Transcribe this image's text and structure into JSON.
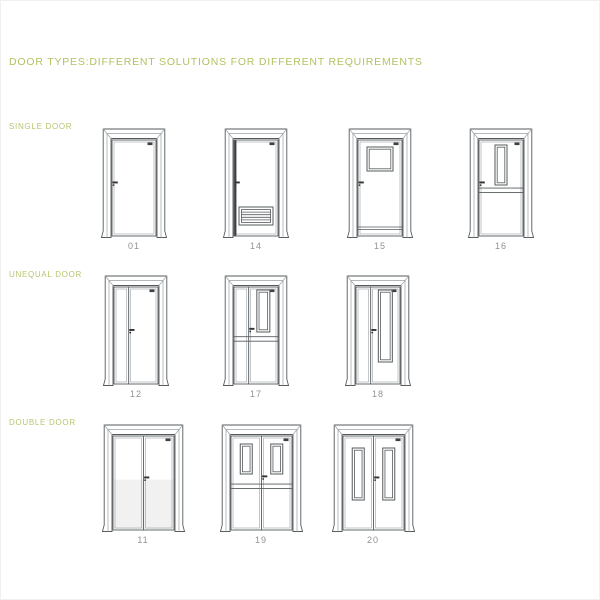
{
  "title": {
    "text": "DOOR TYPES:DIFFERENT SOLUTIONS FOR DIFFERENT REQUIREMENTS"
  },
  "colors": {
    "accent_green": "#b3c161",
    "line": "#565b5e",
    "line_light": "#9aa0a4",
    "dark_detail": "#3c4043",
    "number_gray": "#8f9193",
    "shade": "#f1f1f1",
    "background": "#ffffff"
  },
  "sections": [
    {
      "label": "SINGLE DOOR",
      "label_y": 121,
      "row_y": 126,
      "door_w": 66,
      "door_h": 111,
      "doors": [
        {
          "number": "01",
          "cx": 133,
          "kind": "single",
          "features": []
        },
        {
          "number": "14",
          "cx": 255,
          "kind": "single",
          "features": [
            "louver",
            "edge-left"
          ]
        },
        {
          "number": "15",
          "cx": 379,
          "kind": "single",
          "features": [
            "square-window",
            "kickplate"
          ]
        },
        {
          "number": "16",
          "cx": 500,
          "kind": "single",
          "features": [
            "vertical-window",
            "mid-rail"
          ]
        }
      ]
    },
    {
      "label": "UNEQUAL DOOR",
      "label_y": 269,
      "row_y": 273,
      "door_w": 66,
      "door_h": 112,
      "doors": [
        {
          "number": "12",
          "cx": 135,
          "kind": "unequal",
          "features": []
        },
        {
          "number": "17",
          "cx": 255,
          "kind": "unequal",
          "features": [
            "vertical-window",
            "mid-rail"
          ]
        },
        {
          "number": "18",
          "cx": 377,
          "kind": "unequal",
          "features": [
            "tall-window"
          ]
        }
      ]
    },
    {
      "label": "DOUBLE DOOR",
      "label_y": 417,
      "row_y": 422,
      "door_w": 83,
      "door_h": 109,
      "doors": [
        {
          "number": "11",
          "cx": 142,
          "kind": "double",
          "features": [
            "bottom-shade"
          ]
        },
        {
          "number": "19",
          "cx": 260,
          "kind": "double",
          "features": [
            "pair-windows",
            "mid-rail"
          ]
        },
        {
          "number": "20",
          "cx": 372,
          "kind": "double",
          "features": [
            "pair-tall-windows"
          ]
        }
      ]
    }
  ]
}
